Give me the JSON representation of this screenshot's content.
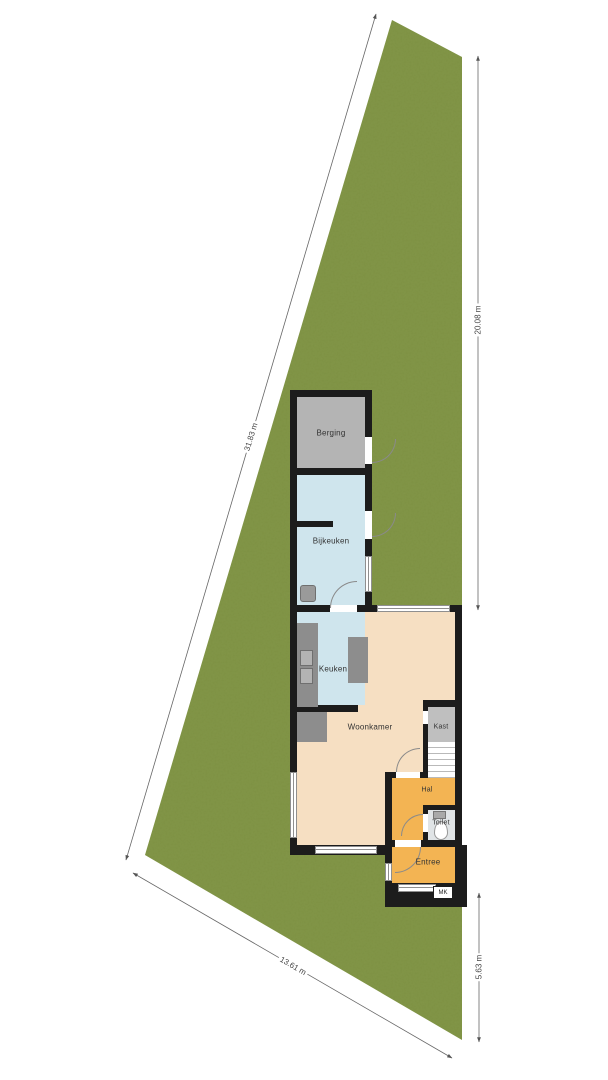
{
  "plot": {
    "dimensions": {
      "left": "31.83 m",
      "right": "20.08 m",
      "bottom": "13.61 m",
      "bottom_right": "5.63 m"
    },
    "colors": {
      "grass": "#7d9143",
      "wall": "#1c1c1c",
      "living_room": "#f6dfc2",
      "kitchen": "#cfe5ed",
      "hallway": "#f3b453",
      "storage": "#b4b4b4",
      "toilet": "#e0e4e6"
    }
  },
  "rooms": {
    "berging": {
      "label": "Berging"
    },
    "bijkeuken": {
      "label": "Bijkeuken"
    },
    "keuken": {
      "label": "Keuken"
    },
    "woonkamer": {
      "label": "Woonkamer"
    },
    "kast": {
      "label": "Kast"
    },
    "hal": {
      "label": "Hal"
    },
    "toilet": {
      "label": "Toilet"
    },
    "entree": {
      "label": "Entree"
    },
    "mk": {
      "label": "MK"
    }
  }
}
